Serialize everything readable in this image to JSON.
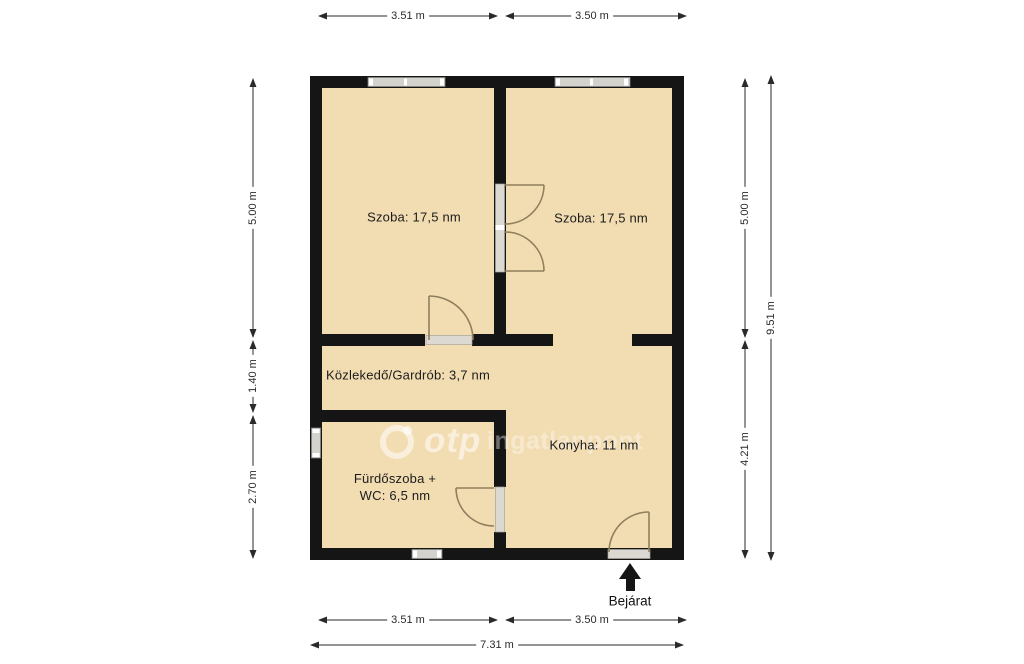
{
  "colors": {
    "floor": "#f2dcb2",
    "wall": "#151515",
    "window": "#d4d2cc",
    "threshold": "#dcd9d2",
    "door_arc": "#8f7f5d",
    "dim_line": "#2a2a2a"
  },
  "rooms": [
    {
      "name": "szoba-left",
      "label": "Szoba: 17,5 nm"
    },
    {
      "name": "szoba-right",
      "label": "Szoba: 17,5 nm"
    },
    {
      "name": "kozlekedo",
      "label": "Közlekedő/Gardrób: 3,7 nm"
    },
    {
      "name": "konyha",
      "label": "Konyha: 11 nm"
    },
    {
      "name": "furdoszoba",
      "label_line1": "Fürdőszoba +",
      "label_line2": "WC: 6,5 nm"
    }
  ],
  "dimensions": {
    "top_left": "3.51 m",
    "top_right": "3.50 m",
    "left_upper": "5.00 m",
    "left_middle": "1.40 m",
    "left_lower": "2.70 m",
    "right_upper": "5.00 m",
    "right_lower": "4.21 m",
    "right_total": "9.51 m",
    "bottom_left": "3.51 m",
    "bottom_right": "3.50 m",
    "bottom_total": "7.31 m"
  },
  "entrance": {
    "label": "Bejárat"
  },
  "watermark": {
    "brand": "otp",
    "suffix": "ingatlanpont"
  }
}
